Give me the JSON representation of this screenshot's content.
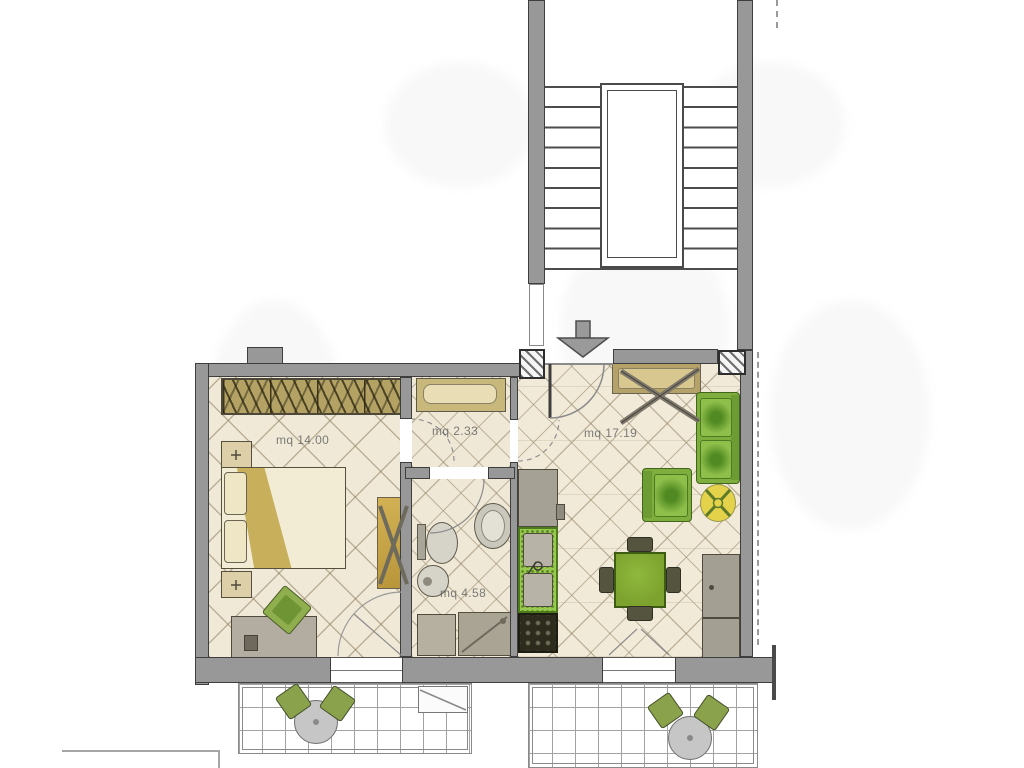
{
  "plan": {
    "type": "apartment-floor-plan",
    "rooms": [
      {
        "name": "bedroom",
        "area_label": "mq 14.00"
      },
      {
        "name": "hallway",
        "area_label": "mq 2.33"
      },
      {
        "name": "living-room",
        "area_label": "mq 17.19"
      },
      {
        "name": "bathroom",
        "area_label": "mq 4.58"
      }
    ],
    "symbols": {
      "entry_arrow": "down-arrow"
    },
    "colors": {
      "wall": "#989898",
      "wall_outline": "#3e3e3e",
      "floor_cream": "#f0e9d7",
      "furniture_tan": "#b5a268",
      "sofa_green": "#7fae3e",
      "kitchen_counter_green": "#98ca4e",
      "side_table_yellow": "#e5d24b",
      "label_text": "#5c5c5c"
    }
  }
}
